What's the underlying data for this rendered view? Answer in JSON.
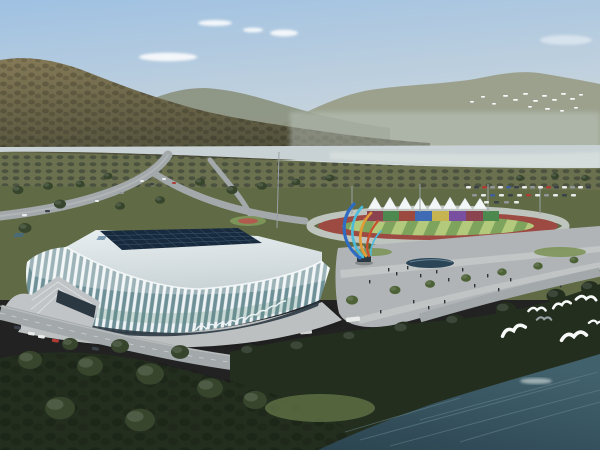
{
  "scene": {
    "title": "Aerial rendering of a white latticed stadium and riverside sports park",
    "colors": {
      "sky-top": "#9fc1e2",
      "sky-mid": "#c3d2dd",
      "sky-horizon": "#dfe6e6",
      "cloud": "#ffffff",
      "hill-light": "#857a57",
      "hill-dark": "#50503b",
      "hill-shadow": "#3f4230",
      "ridge-mid": "#8a907c",
      "ridge-far": "#9ba18d",
      "haze": "#c3cdc9",
      "river": "#c8d2d4",
      "river-bright": "#d7dedd",
      "orchard": "#6b714f",
      "orchard-dot": "#4b5340",
      "grass-mid": "#606b46",
      "grass-light": "#7d9459",
      "road": "#a3a8ab",
      "road-light": "#bcc0c1",
      "tree-dark": "#232e1e",
      "tree-mid": "#36452c",
      "tree-light": "#4c6136",
      "track-red": "#9c4a42",
      "track-ring": "#c9cfcb",
      "field-light": "#b3c97c",
      "field-dark": "#7ea35c",
      "field-pink": "#b97b74",
      "tent": "#f3f6f6",
      "stand-1": "#8c4350",
      "stand-2": "#4d894e",
      "stand-3": "#9c4a40",
      "stand-4": "#3e6bb4",
      "stand-5": "#c6b352",
      "stand-6": "#78509f",
      "stand-7": "#8c4350",
      "stand-8": "#4d894e",
      "plaza": "#b0b4b6",
      "plaza-light": "#c7cacb",
      "pool": "#2b4557",
      "roof": "#cbd5d8",
      "roof-light": "#e8eef0",
      "skylight": "#182a3d",
      "skylight-grid": "#44617b",
      "skylight-glint": "#3e6a8e",
      "rib": "#eef3f5",
      "glass": "#6e9097",
      "glass-green": "#5c8a7d",
      "base-dark": "#2b3842",
      "stairs": "#c0c4c6",
      "water-deep": "#2b4450",
      "water-mid": "#41616d",
      "ripple": "#6a8891",
      "bird-white": "#f8fafa",
      "bird-gray": "#97a1a4",
      "people": "#2d3337",
      "car-white": "#e9ebeb",
      "car-red": "#ae3c35",
      "car-dark": "#39424a",
      "car-blue": "#3e5f9e",
      "car-gray": "#8f9799",
      "sculpt-blue": "#2e6cc3",
      "sculpt-cyan": "#4cbbdb",
      "sculpt-orange": "#e39c35",
      "sculpt-red": "#c9502f",
      "mast": "#98a0a3",
      "flower": "#b25a4e"
    },
    "counts": {
      "tents": 8,
      "grandstand-blocks": 8,
      "foreground-birds": 7,
      "distant-birds": 16
    }
  }
}
